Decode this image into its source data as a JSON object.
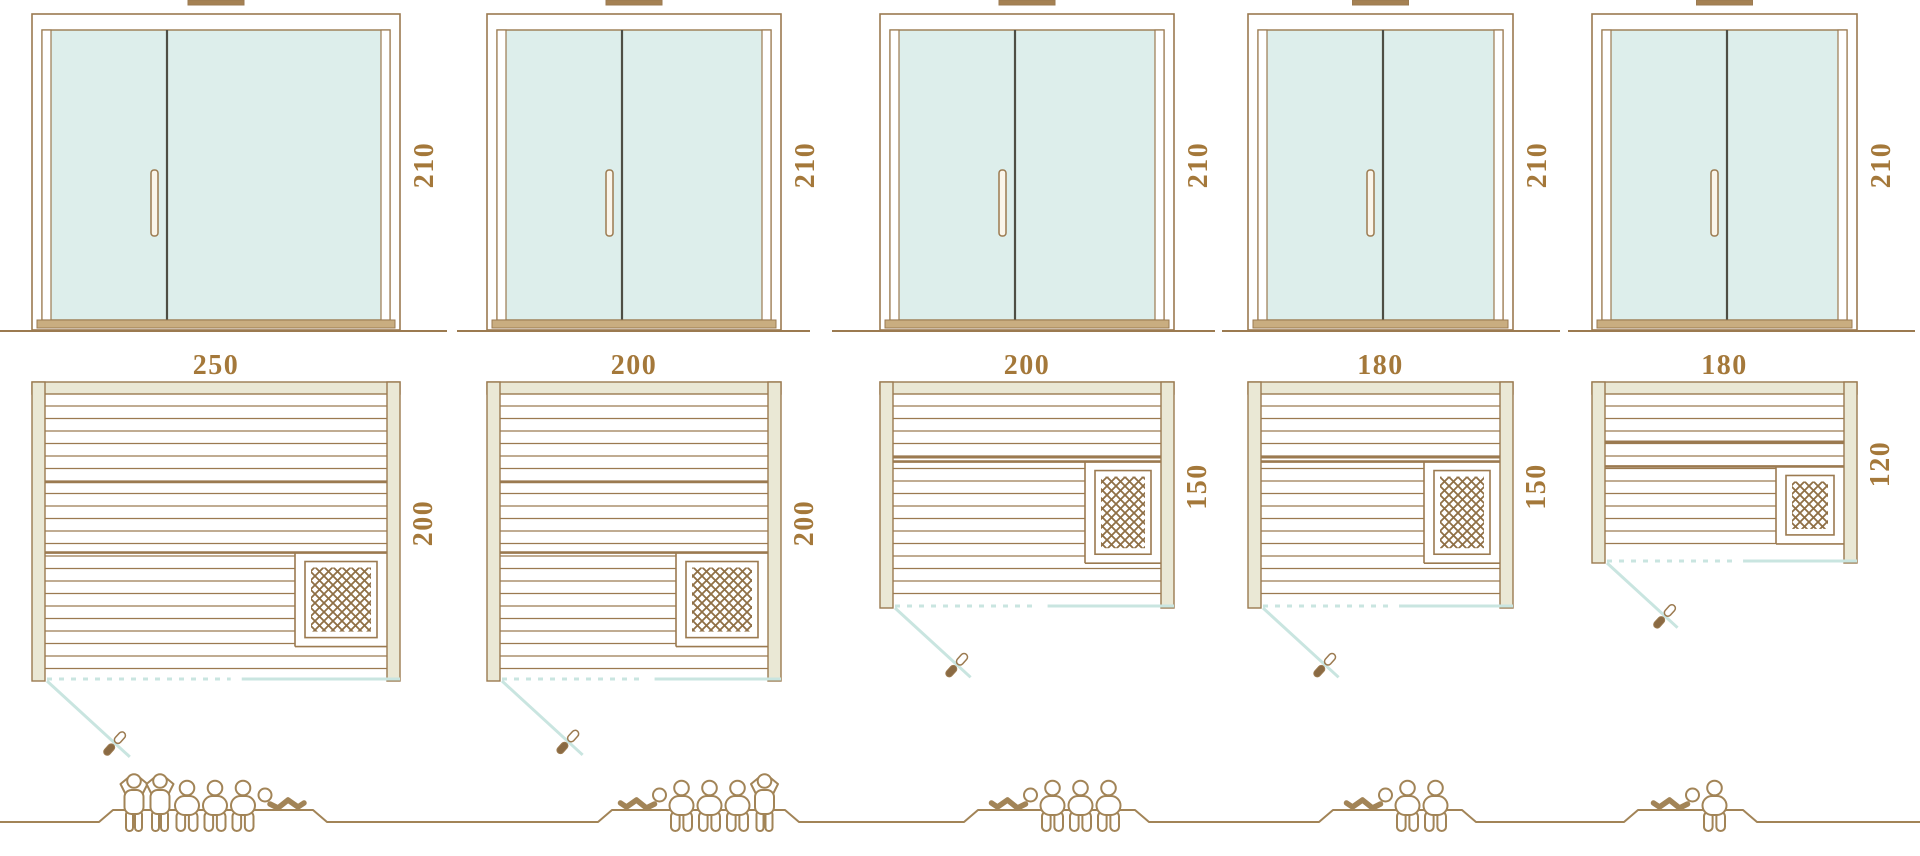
{
  "colors": {
    "outline": "#9b7a50",
    "people_outline": "#a28457",
    "label_text": "#a4783a",
    "wood_frame_fill": "#eae8d5",
    "glass_fill": "#ddeeeb",
    "teal_accent": "#c9e5e0",
    "door_divider": "#4e4e44",
    "threshold_fill": "#c9ad80",
    "heater_hatch": "#8f6f45",
    "vent_fill": "#a58153",
    "swing_handle_fill": "#8a6a43"
  },
  "icons": {
    "standing_person": "standing-person-icon",
    "sitting_person": "sitting-person-icon",
    "lying_person": "lying-person-icon",
    "heater_grid": "heater-grid-icon",
    "door_swing_handle": "door-handle-icon"
  },
  "saunas": [
    {
      "door_height_label": "210",
      "width_label": "250",
      "depth_label": "200",
      "capacity": 6,
      "people": [
        "stand",
        "stand",
        "sit",
        "sit",
        "sit",
        "lie"
      ]
    },
    {
      "door_height_label": "210",
      "width_label": "200",
      "depth_label": "200",
      "capacity": 5,
      "people": [
        "lie",
        "sit",
        "sit",
        "sit",
        "stand"
      ]
    },
    {
      "door_height_label": "210",
      "width_label": "200",
      "depth_label": "150",
      "capacity": 4,
      "people": [
        "lie",
        "sit",
        "sit",
        "sit"
      ]
    },
    {
      "door_height_label": "210",
      "width_label": "180",
      "depth_label": "150",
      "capacity": 3,
      "people": [
        "lie",
        "sit",
        "sit"
      ]
    },
    {
      "door_height_label": "210",
      "width_label": "180",
      "depth_label": "120",
      "capacity": 2,
      "people": [
        "lie",
        "sit"
      ]
    }
  ]
}
